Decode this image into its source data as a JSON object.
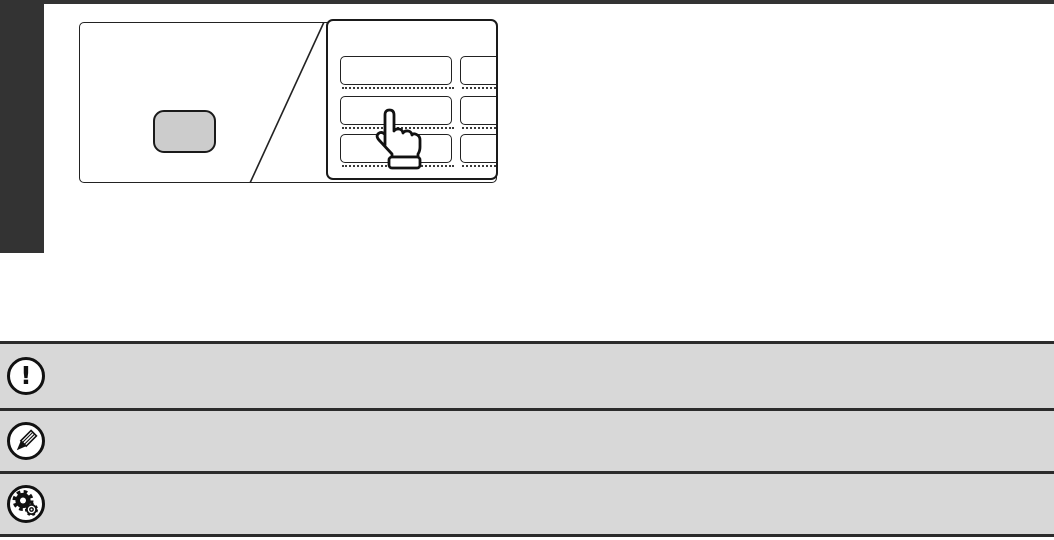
{
  "document": {
    "kind": "manual-page-excerpt",
    "background": "#ffffff",
    "top_rule_color": "#333333",
    "chapter_tab_color": "#333333"
  },
  "illustration": {
    "name": "operation-panel-with-touch-screen-blowup",
    "outline_color": "#222222",
    "machine_key_fill": "#cccccc",
    "touch_panel": {
      "button_rows": 3,
      "button_columns": 2
    },
    "pointer": "hand-pointing"
  },
  "note_rows": [
    {
      "name": "caution",
      "icon": "exclamation-icon",
      "glyph": "!"
    },
    {
      "name": "note",
      "icon": "pencil-icon"
    },
    {
      "name": "system-settings",
      "icon": "gears-icon"
    }
  ],
  "colors": {
    "note_bar_fill": "#d8d8d8",
    "note_bar_border": "#2b2b2b",
    "icon_circle_fill": "#ffffff",
    "icon_stroke": "#111111"
  }
}
